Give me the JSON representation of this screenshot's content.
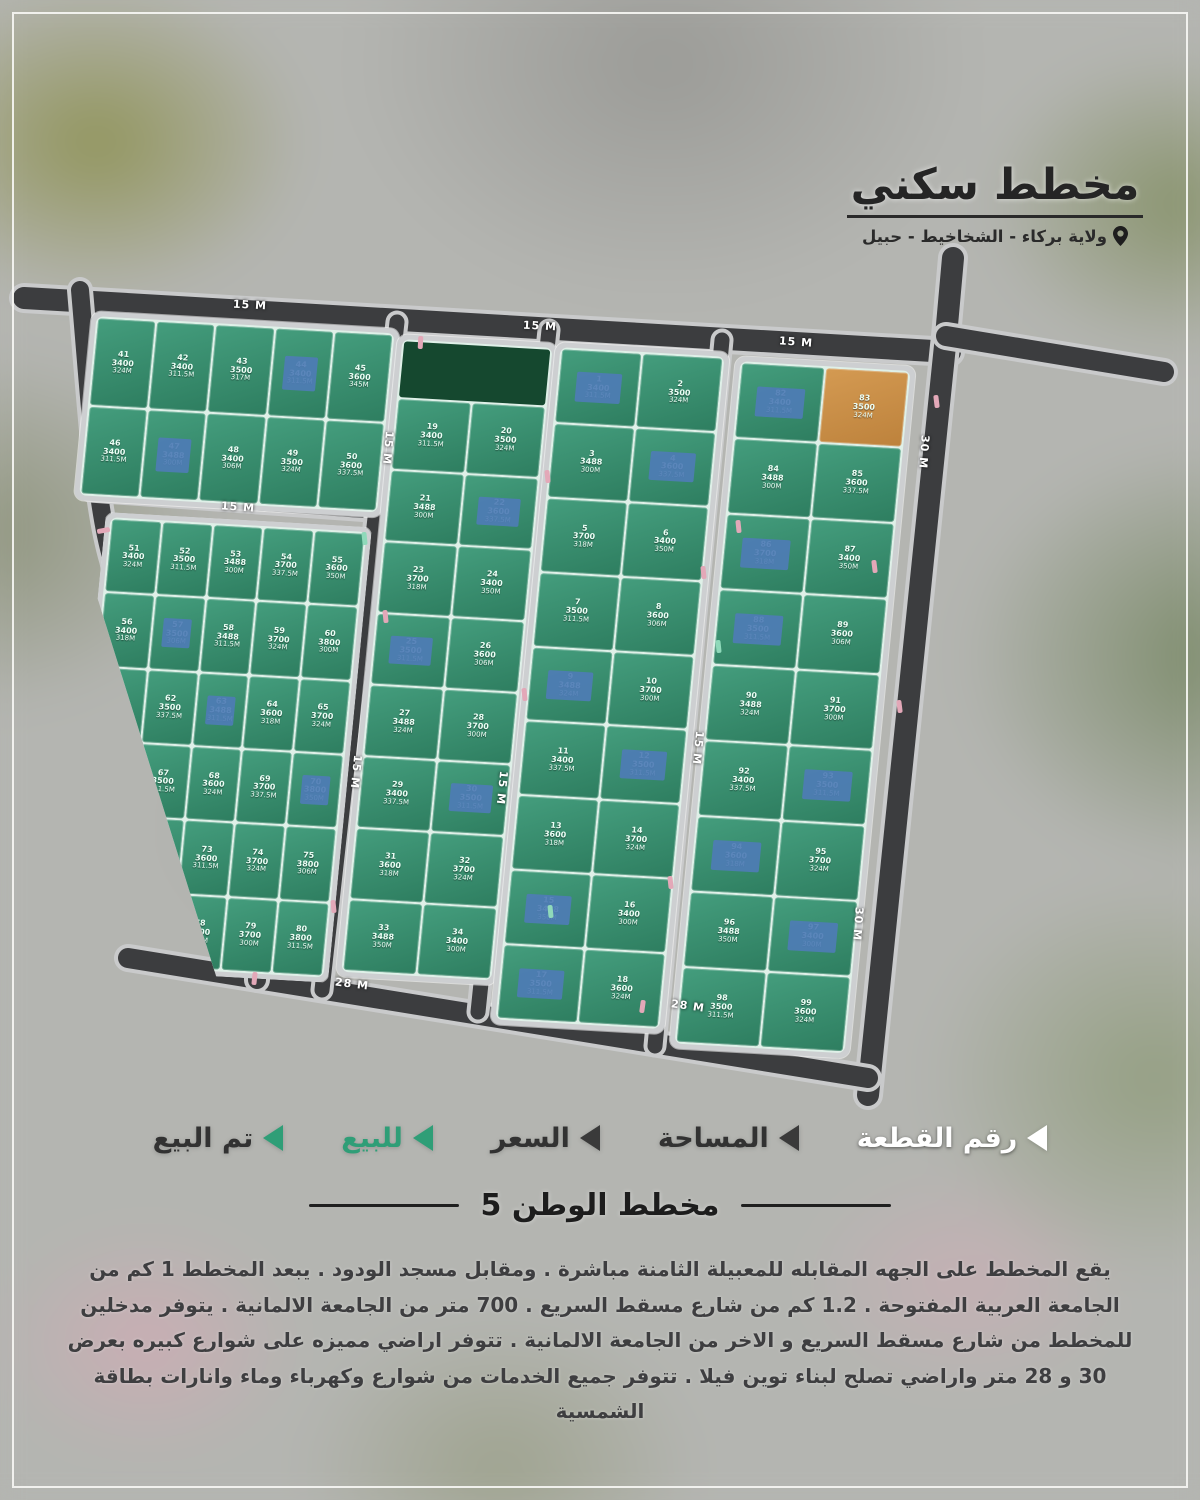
{
  "header": {
    "title": "مخطط سكني",
    "location": "ولاية بركاء - الشخاخيط - حبيل"
  },
  "section": {
    "title": "مخطط الوطن 5"
  },
  "description": "يقع المخطط على الجهه المقابله للمعبيلة الثامنة مباشرة . ومقابل مسجد الودود . يبعد المخطط 1 كم من الجامعة العربية المفتوحة . 1.2 كم من شارع مسقط السريع . 700 متر من الجامعة الالمانية . يتوفر مدخلين للمخطط من شارع مسقط السريع و الاخر من الجامعة الالمانية . تتوفر اراضي مميزه على شوارع كبيره بعرض 30 و 28 متر واراضي تصلح لبناء توين فيلا . تتوفر جميع الخدمات من شوارع وكهرباء وماء وانارات بطاقة الشمسية",
  "legend": {
    "items": [
      {
        "label": "رقم القطعة",
        "arrow_color": "#ffffff",
        "text_color": "#ffffff"
      },
      {
        "label": "المساحة",
        "arrow_color": "#3a3a3a",
        "text_color": "#323232"
      },
      {
        "label": "السعر",
        "arrow_color": "#3a3a3a",
        "text_color": "#323232"
      },
      {
        "label": "للبيع",
        "arrow_color": "#2f9e77",
        "text_color": "#2f9e77"
      },
      {
        "label": "تم البيع",
        "arrow_color": "#2f9e77",
        "text_color": "#323232"
      }
    ]
  },
  "colors": {
    "plot_green": "#3c9173",
    "sold_blue": "#4e7cb5",
    "reserved_orange": "#cd9350",
    "road_asphalt": "#3c3d3f",
    "mosque_green": "#15482f"
  },
  "map": {
    "road_labels": [
      {
        "text": "15 M",
        "x": 250,
        "y": 305,
        "rot": 3
      },
      {
        "text": "15 M",
        "x": 540,
        "y": 326,
        "rot": 3
      },
      {
        "text": "15 M",
        "x": 796,
        "y": 342,
        "rot": 4
      },
      {
        "text": "15 M",
        "x": 238,
        "y": 507,
        "rot": 4
      },
      {
        "text": "15 M",
        "x": 388,
        "y": 448,
        "rot": 95
      },
      {
        "text": "15 M",
        "x": 356,
        "y": 772,
        "rot": 96
      },
      {
        "text": "15 M",
        "x": 502,
        "y": 788,
        "rot": 96
      },
      {
        "text": "15 M",
        "x": 698,
        "y": 748,
        "rot": 96
      },
      {
        "text": "30 M",
        "x": 924,
        "y": 452,
        "rot": 94
      },
      {
        "text": "30 M",
        "x": 858,
        "y": 924,
        "rot": 94
      },
      {
        "text": "28 M",
        "x": 352,
        "y": 984,
        "rot": 7
      },
      {
        "text": "28 M",
        "x": 688,
        "y": 1006,
        "rot": 8
      }
    ],
    "blocks": [
      {
        "name": "block-top-left",
        "plots": [
          {
            "n": "41",
            "p": "3400",
            "a": "324M"
          },
          {
            "n": "42",
            "p": "3400",
            "a": "311.5M"
          },
          {
            "n": "43",
            "p": "3500",
            "a": "317M"
          },
          {
            "n": "44",
            "p": "3400",
            "a": "311.5M",
            "s": "b"
          },
          {
            "n": "45",
            "p": "3600",
            "a": "345M"
          },
          {
            "n": "46",
            "p": "3400",
            "a": "311.5M"
          },
          {
            "n": "47",
            "p": "3488",
            "a": "300M",
            "s": "b"
          },
          {
            "n": "48",
            "p": "3400",
            "a": "306M"
          },
          {
            "n": "49",
            "p": "3500",
            "a": "324M"
          },
          {
            "n": "50",
            "p": "3600",
            "a": "337.5M"
          }
        ]
      },
      {
        "name": "block-left",
        "plots": [
          {
            "n": "51",
            "p": "3400",
            "a": "324M"
          },
          {
            "n": "52",
            "p": "3500",
            "a": "311.5M"
          },
          {
            "n": "53",
            "p": "3488",
            "a": "300M"
          },
          {
            "n": "54",
            "p": "3700",
            "a": "337.5M"
          },
          {
            "n": "55",
            "p": "3600",
            "a": "350M"
          },
          {
            "n": "56",
            "p": "3400",
            "a": "318M"
          },
          {
            "n": "57",
            "p": "3500",
            "a": "306M",
            "s": "b"
          },
          {
            "n": "58",
            "p": "3488",
            "a": "311.5M"
          },
          {
            "n": "59",
            "p": "3700",
            "a": "324M"
          },
          {
            "n": "60",
            "p": "3800",
            "a": "300M"
          },
          {
            "n": "61",
            "p": "3400",
            "a": "350M"
          },
          {
            "n": "62",
            "p": "3500",
            "a": "337.5M"
          },
          {
            "n": "63",
            "p": "3488",
            "a": "311.5M",
            "s": "b"
          },
          {
            "n": "64",
            "p": "3600",
            "a": "318M"
          },
          {
            "n": "65",
            "p": "3700",
            "a": "324M"
          },
          {
            "n": "66",
            "p": "3400",
            "a": "300M"
          },
          {
            "n": "67",
            "p": "3500",
            "a": "311.5M"
          },
          {
            "n": "68",
            "p": "3600",
            "a": "324M"
          },
          {
            "n": "69",
            "p": "3700",
            "a": "337.5M"
          },
          {
            "n": "70",
            "p": "3800",
            "a": "350M",
            "s": "b"
          },
          {
            "n": "71",
            "p": "3400",
            "a": "318M"
          },
          {
            "n": "72",
            "p": "3500",
            "a": "300M"
          },
          {
            "n": "73",
            "p": "3600",
            "a": "311.5M"
          },
          {
            "n": "74",
            "p": "3700",
            "a": "324M"
          },
          {
            "n": "75",
            "p": "3800",
            "a": "306M"
          },
          {
            "n": "76",
            "p": "3400",
            "a": "337.5M"
          },
          {
            "n": "77",
            "p": "3500",
            "a": "350M"
          },
          {
            "n": "78",
            "p": "3600",
            "a": "318M"
          },
          {
            "n": "79",
            "p": "3700",
            "a": "300M"
          },
          {
            "n": "80",
            "p": "3800",
            "a": "311.5M"
          }
        ]
      },
      {
        "name": "block-center-1",
        "plots": [
          {
            "n": "19",
            "p": "3400",
            "a": "311.5M"
          },
          {
            "n": "20",
            "p": "3500",
            "a": "324M"
          },
          {
            "n": "21",
            "p": "3488",
            "a": "300M"
          },
          {
            "n": "22",
            "p": "3600",
            "a": "337.5M",
            "s": "b"
          },
          {
            "n": "23",
            "p": "3700",
            "a": "318M"
          },
          {
            "n": "24",
            "p": "3400",
            "a": "350M"
          },
          {
            "n": "25",
            "p": "3500",
            "a": "311.5M",
            "s": "b"
          },
          {
            "n": "26",
            "p": "3600",
            "a": "306M"
          },
          {
            "n": "27",
            "p": "3488",
            "a": "324M"
          },
          {
            "n": "28",
            "p": "3700",
            "a": "300M"
          },
          {
            "n": "29",
            "p": "3400",
            "a": "337.5M"
          },
          {
            "n": "30",
            "p": "3500",
            "a": "311.5M",
            "s": "b"
          },
          {
            "n": "31",
            "p": "3600",
            "a": "318M"
          },
          {
            "n": "32",
            "p": "3700",
            "a": "324M"
          },
          {
            "n": "33",
            "p": "3488",
            "a": "350M"
          },
          {
            "n": "34",
            "p": "3400",
            "a": "300M"
          }
        ]
      },
      {
        "name": "block-center-2",
        "plots": [
          {
            "n": "1",
            "p": "3400",
            "a": "311.5M",
            "s": "b"
          },
          {
            "n": "2",
            "p": "3500",
            "a": "324M"
          },
          {
            "n": "3",
            "p": "3488",
            "a": "300M"
          },
          {
            "n": "4",
            "p": "3600",
            "a": "337.5M",
            "s": "b"
          },
          {
            "n": "5",
            "p": "3700",
            "a": "318M"
          },
          {
            "n": "6",
            "p": "3400",
            "a": "350M"
          },
          {
            "n": "7",
            "p": "3500",
            "a": "311.5M"
          },
          {
            "n": "8",
            "p": "3600",
            "a": "306M"
          },
          {
            "n": "9",
            "p": "3488",
            "a": "324M",
            "s": "b"
          },
          {
            "n": "10",
            "p": "3700",
            "a": "300M"
          },
          {
            "n": "11",
            "p": "3400",
            "a": "337.5M"
          },
          {
            "n": "12",
            "p": "3500",
            "a": "311.5M",
            "s": "b"
          },
          {
            "n": "13",
            "p": "3600",
            "a": "318M"
          },
          {
            "n": "14",
            "p": "3700",
            "a": "324M"
          },
          {
            "n": "15",
            "p": "3488",
            "a": "350M",
            "s": "b"
          },
          {
            "n": "16",
            "p": "3400",
            "a": "300M"
          },
          {
            "n": "17",
            "p": "3500",
            "a": "311.5M",
            "s": "b"
          },
          {
            "n": "18",
            "p": "3600",
            "a": "324M"
          }
        ]
      },
      {
        "name": "block-right",
        "plots": [
          {
            "n": "82",
            "p": "3400",
            "a": "311.5M",
            "s": "b"
          },
          {
            "n": "83",
            "p": "3500",
            "a": "324M",
            "s": "o"
          },
          {
            "n": "84",
            "p": "3488",
            "a": "300M"
          },
          {
            "n": "85",
            "p": "3600",
            "a": "337.5M"
          },
          {
            "n": "86",
            "p": "3700",
            "a": "318M",
            "s": "b"
          },
          {
            "n": "87",
            "p": "3400",
            "a": "350M"
          },
          {
            "n": "88",
            "p": "3500",
            "a": "311.5M",
            "s": "b"
          },
          {
            "n": "89",
            "p": "3600",
            "a": "306M"
          },
          {
            "n": "90",
            "p": "3488",
            "a": "324M"
          },
          {
            "n": "91",
            "p": "3700",
            "a": "300M"
          },
          {
            "n": "92",
            "p": "3400",
            "a": "337.5M"
          },
          {
            "n": "93",
            "p": "3500",
            "a": "311.5M",
            "s": "b"
          },
          {
            "n": "94",
            "p": "3600",
            "a": "318M",
            "s": "b"
          },
          {
            "n": "95",
            "p": "3700",
            "a": "324M"
          },
          {
            "n": "96",
            "p": "3488",
            "a": "350M"
          },
          {
            "n": "97",
            "p": "3400",
            "a": "300M",
            "s": "b"
          },
          {
            "n": "98",
            "p": "3500",
            "a": "311.5M"
          },
          {
            "n": "99",
            "p": "3600",
            "a": "324M"
          }
        ]
      }
    ]
  }
}
